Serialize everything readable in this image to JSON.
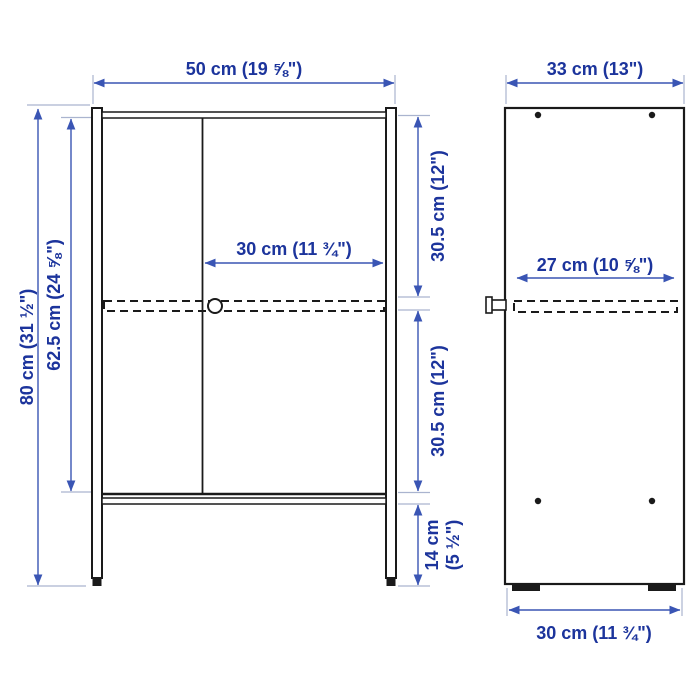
{
  "front_view": {
    "width": "50 cm (19 ⅝\")",
    "height": "80 cm (31 ½\")",
    "interior_height": "62.5 cm (24 ⅝\")",
    "door_width": "30 cm (11 ¾\")",
    "upper_section_height": "30.5 cm (12\")",
    "lower_section_height": "30.5 cm (12\")",
    "leg_height_line1": "14 cm",
    "leg_height_line2": "(5 ½\")"
  },
  "side_view": {
    "depth": "33 cm (13\")",
    "shelf_depth": "27 cm (10 ⅝\")",
    "base_depth": "30 cm (11 ¾\")"
  },
  "colors": {
    "drawing_line": "#1a1a1a",
    "dimension_line": "#3a55b4",
    "dimension_text": "#1c349c",
    "extension_line": "#aab4cf",
    "background": "#ffffff"
  }
}
